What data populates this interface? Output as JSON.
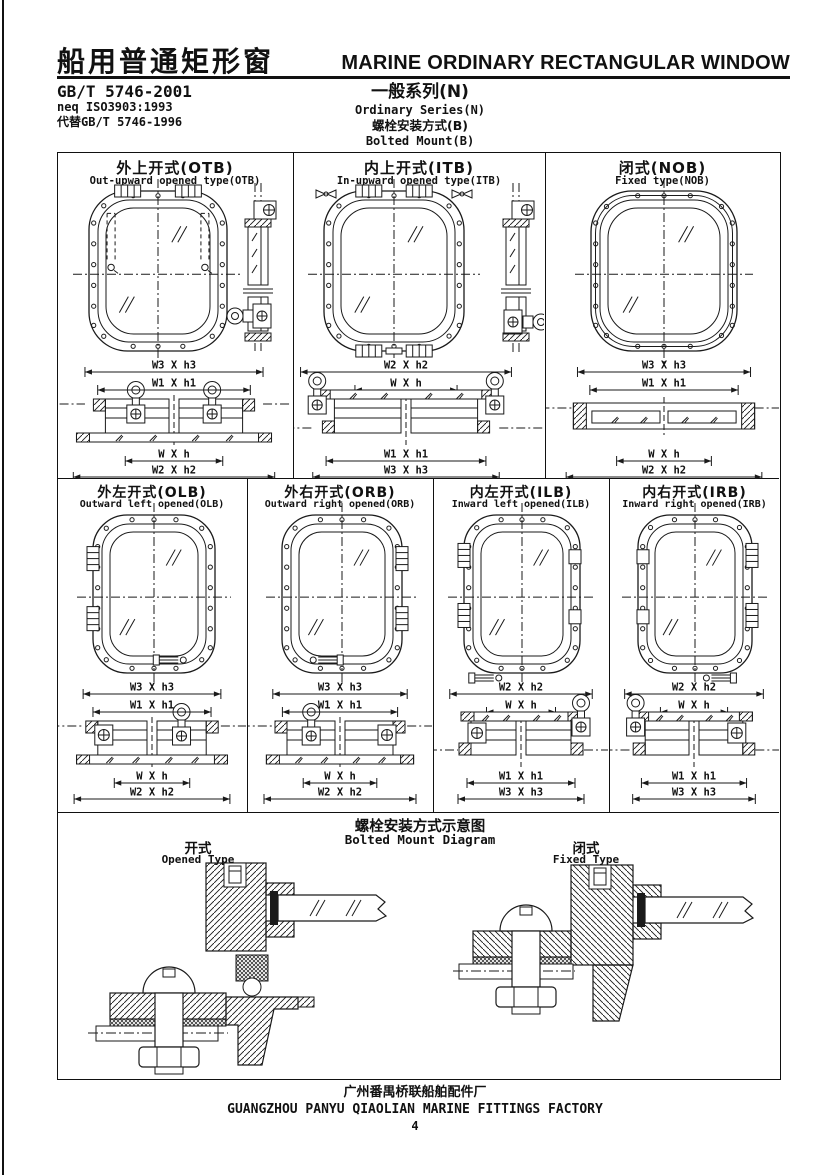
{
  "header": {
    "title_cn": "船用普通矩形窗",
    "title_en": "MARINE ORDINARY RECTANGULAR WINDOW",
    "std_code": "GB/T 5746-2001",
    "std_neq": "neq ISO3903:1993",
    "std_replaces": "代替GB/T 5746-1996",
    "series_cn": "一般系列(N)",
    "series_en": "Ordinary Series(N)",
    "mount_cn": "螺栓安装方式(B)",
    "mount_en": "Bolted Mount(B)"
  },
  "cells": [
    {
      "title_cn": "外上开式(OTB)",
      "title_en": "Out-upward opened type(OTB)",
      "dims": [
        "W3 X h3",
        "W1 X h1",
        "W X h",
        "W2 X h2"
      ]
    },
    {
      "title_cn": "内上开式(ITB)",
      "title_en": "In-upward opened type(ITB)",
      "dims": [
        "W2 X h2",
        "W X h",
        "W1 X h1",
        "W3 X h3"
      ]
    },
    {
      "title_cn": "闭式(NOB)",
      "title_en": "Fixed type(NOB)",
      "dims": [
        "W3 X h3",
        "W1 X h1",
        "W X h",
        "W2 X h2"
      ]
    },
    {
      "title_cn": "外左开式(OLB)",
      "title_en": "Outward left opened(OLB)",
      "dims": [
        "W3 X h3",
        "W1 X h1",
        "W X h",
        "W2 X h2"
      ]
    },
    {
      "title_cn": "外右开式(ORB)",
      "title_en": "Outward right opened(ORB)",
      "dims": [
        "W3 X h3",
        "W1 X h1",
        "W X h",
        "W2 X h2"
      ]
    },
    {
      "title_cn": "内左开式(ILB)",
      "title_en": "Inward left opened(ILB)",
      "dims": [
        "W2 X h2",
        "W X h",
        "W1 X h1",
        "W3 X h3"
      ]
    },
    {
      "title_cn": "内右开式(IRB)",
      "title_en": "Inward right opened(IRB)",
      "dims": [
        "W2 X h2",
        "W X h",
        "W1 X h1",
        "W3 X h3"
      ]
    }
  ],
  "diagram": {
    "title_cn": "螺栓安装方式示意图",
    "title_en": "Bolted Mount Diagram",
    "opened_cn": "开式",
    "opened_en": "Opened Type",
    "fixed_cn": "闭式",
    "fixed_en": "Fixed Type"
  },
  "footer": {
    "factory_cn": "广州番禺桥联船舶配件厂",
    "factory_en": "GUANGZHOU PANYU QIAOLIAN MARINE FITTINGS FACTORY",
    "page": "4"
  },
  "colors": {
    "ink": "#1a1a1a",
    "paper": "#ffffff"
  }
}
